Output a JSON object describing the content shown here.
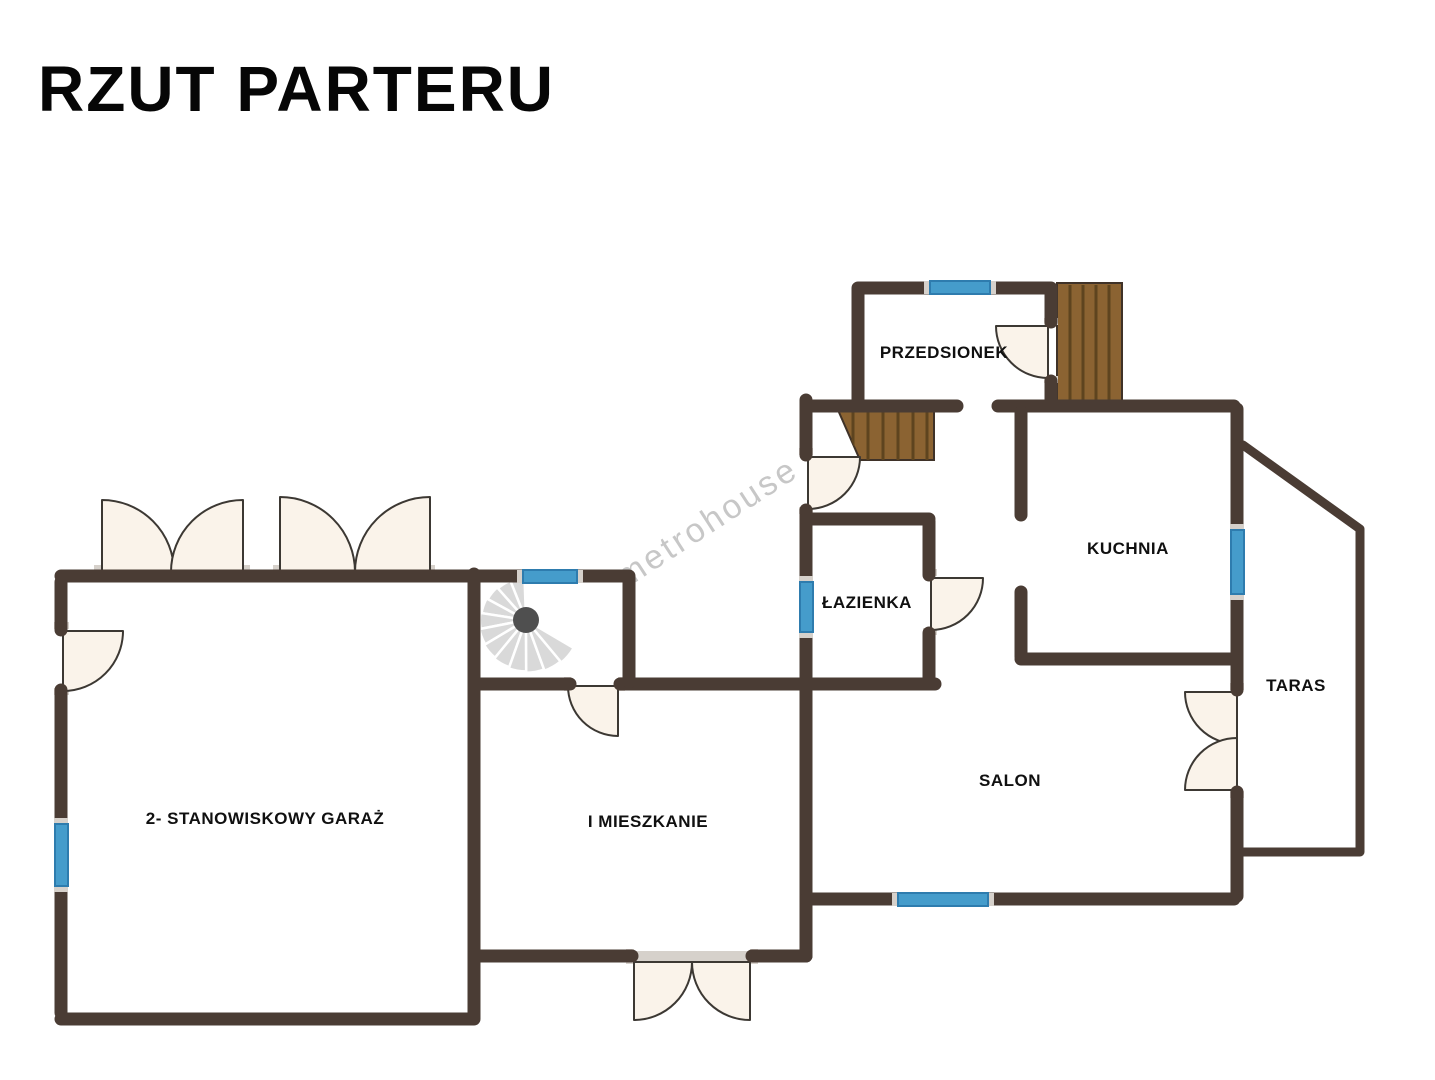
{
  "title": "RZUT PARTERU",
  "watermark": "metrohouse",
  "rooms": [
    {
      "id": "przedsionek",
      "label": "PRZEDSIONEK"
    },
    {
      "id": "lazienka",
      "label": "ŁAZIENKA"
    },
    {
      "id": "kuchnia",
      "label": "KUCHNIA"
    },
    {
      "id": "taras",
      "label": "TARAS"
    },
    {
      "id": "salon",
      "label": "SALON"
    },
    {
      "id": "garaz",
      "label": "2- STANOWISKOWY GARAŻ"
    },
    {
      "id": "mieszkanie",
      "label": "I MIESZKANIE"
    }
  ],
  "colors": {
    "wall": "#4a3c34",
    "window": "#459ccb",
    "window_border": "#2e7cae",
    "door_fill": "#faf3ea",
    "door_stroke": "#3c3833",
    "wood": "#8b6332",
    "wood_line": "#5e441f",
    "stair": "#d9d9d9",
    "stair_center": "#4f4f4f",
    "frame": "#d6d1cb",
    "watermark": "#c7c7c7"
  }
}
